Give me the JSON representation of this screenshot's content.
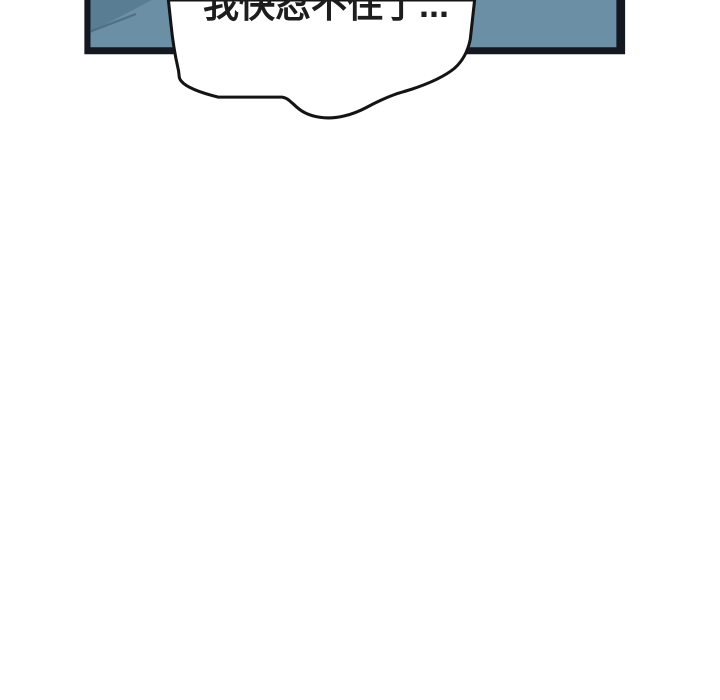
{
  "comic": {
    "page_background": "#ffffff",
    "panel": {
      "frame_color": "#141821",
      "art_color": "#6b8fa5",
      "art_shade_color": "#597e93",
      "art_shade_line_color": "#4c6c80"
    },
    "speech_bubble": {
      "text": "我快忍不住了...",
      "fill": "#ffffff",
      "outline_color": "#141414"
    }
  }
}
